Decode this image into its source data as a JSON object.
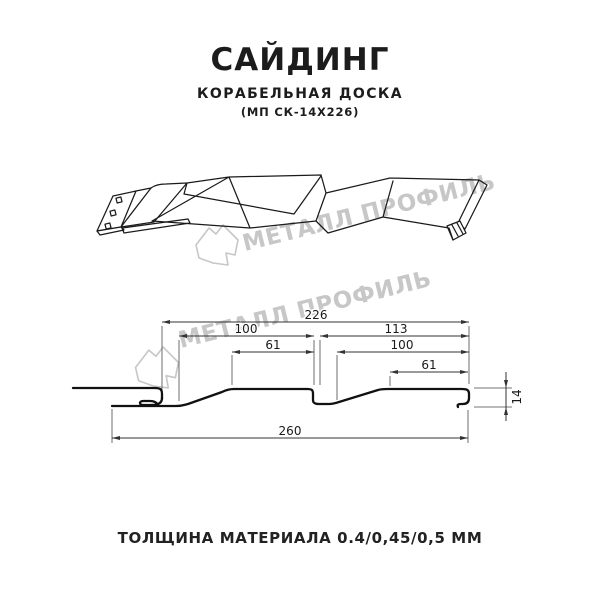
{
  "header": {
    "title": "САЙДИНГ",
    "subtitle": "КОРАБЕЛЬНАЯ ДОСКА",
    "model_code": "(МП СК-14Х226)"
  },
  "watermark": {
    "brand": "МЕТАЛЛ ПРОФИЛЬ",
    "color": "#c7c7c7"
  },
  "dimensions": {
    "overall_top": "226",
    "left_section": "100",
    "right_section": "113",
    "left_inner": "61",
    "right_inner": "100",
    "right_top": "61",
    "overall_bottom": "260",
    "profile_height": "14"
  },
  "footer": {
    "thickness_note": "ТОЛЩИНА МАТЕРИАЛА 0.4/0,45/0,5 ММ"
  }
}
